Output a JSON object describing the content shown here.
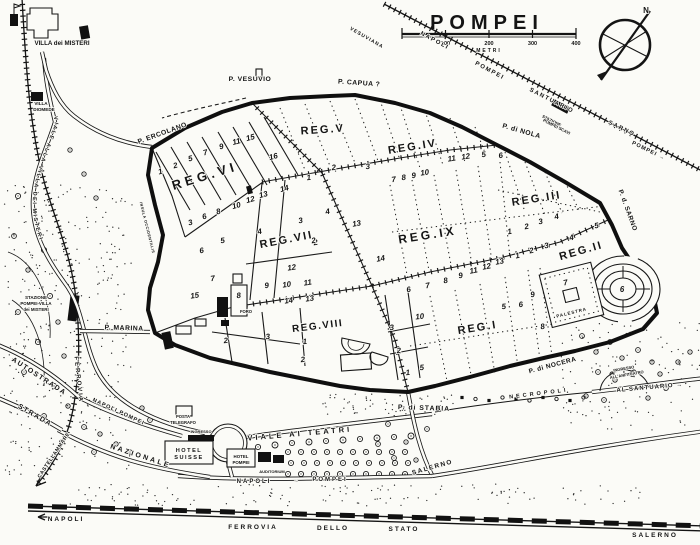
{
  "title": "POMPEI",
  "scale_bar": {
    "unit": "METRI",
    "ticks": [
      "100",
      "200",
      "300",
      "400"
    ]
  },
  "compass": {
    "north": "N"
  },
  "roads_text": {
    "viale_alla_villa": "VIALE ALLA VILLA DEI MISTERI"
  },
  "regions": [
    {
      "name": "region-label-vi",
      "text": "REG.VI",
      "x": 206,
      "y": 180,
      "rot": -17,
      "size": 13,
      "ls": 4
    },
    {
      "name": "region-label-v",
      "text": "REG.V",
      "x": 323,
      "y": 133,
      "rot": -4,
      "size": 11,
      "ls": 2
    },
    {
      "name": "region-label-iv",
      "text": "REG.IV",
      "x": 413,
      "y": 150,
      "rot": -9,
      "size": 11,
      "ls": 2
    },
    {
      "name": "region-label-iii",
      "text": "REG.III",
      "x": 537,
      "y": 202,
      "rot": -9,
      "size": 11,
      "ls": 2
    },
    {
      "name": "region-label-vii",
      "text": "REG.VII",
      "x": 287,
      "y": 243,
      "rot": -11,
      "size": 11,
      "ls": 2
    },
    {
      "name": "region-label-ix",
      "text": "REG.IX",
      "x": 428,
      "y": 239,
      "rot": -9,
      "size": 12,
      "ls": 3
    },
    {
      "name": "region-label-viii",
      "text": "REG.VIII",
      "x": 318,
      "y": 329,
      "rot": -7,
      "size": 10,
      "ls": 1.5
    },
    {
      "name": "region-label-i",
      "text": "REG.I",
      "x": 478,
      "y": 331,
      "rot": -9,
      "size": 11,
      "ls": 2
    },
    {
      "name": "region-label-ii",
      "text": "REG.II",
      "x": 582,
      "y": 254,
      "rot": -16,
      "size": 11,
      "ls": 2
    }
  ],
  "gates": [
    {
      "name": "gate-label-ercolano",
      "text": "P. ERCOLANO",
      "x": 163,
      "y": 135,
      "rot": -20,
      "size": 6.8,
      "ls": 0.5
    },
    {
      "name": "gate-label-vesuvio",
      "text": "P. VESUVIO",
      "x": 250,
      "y": 81,
      "size": 6.8,
      "ls": 0.5
    },
    {
      "name": "gate-label-capua",
      "text": "P. CAPUA ?",
      "x": 359,
      "y": 85,
      "rot": 4,
      "size": 6.8,
      "ls": 0.5
    },
    {
      "name": "gate-label-nola",
      "text": "P. di NOLA",
      "x": 521,
      "y": 133,
      "rot": 16,
      "size": 6.8,
      "ls": 0.5
    },
    {
      "name": "gate-label-sarno",
      "text": "P. d. SARNO",
      "x": 626,
      "y": 211,
      "rot": 70,
      "size": 6.5,
      "ls": 0.5
    },
    {
      "name": "gate-label-nocera",
      "text": "P. di NOCERA",
      "x": 553,
      "y": 367,
      "rot": -15,
      "size": 6.5,
      "ls": 0.5
    },
    {
      "name": "gate-label-stabia",
      "text": "P. di STABIA",
      "x": 424,
      "y": 410,
      "rot": 2,
      "size": 6.8,
      "ls": 1
    },
    {
      "name": "gate-label-marina",
      "text": "P. MARINA",
      "x": 124,
      "y": 330,
      "rot": 2,
      "size": 6.8,
      "ls": 0.5
    }
  ],
  "railway_labels": [
    {
      "name": "railway-label-vesuviana",
      "text": "VESUVIANA",
      "x": 366,
      "y": 39,
      "rot": 30,
      "size": 5,
      "ls": 1
    },
    {
      "name": "railway-label-napoli",
      "text": "NAPOLI",
      "x": 434,
      "y": 42,
      "rot": 28,
      "size": 6,
      "ls": 1.5
    },
    {
      "name": "railway-label-pompei",
      "text": "POMPEI",
      "x": 489,
      "y": 72,
      "rot": 28,
      "size": 6,
      "ls": 1.5
    },
    {
      "name": "railway-label-santuario",
      "text": "SANTUARIO",
      "x": 551,
      "y": 102,
      "rot": 27,
      "size": 6,
      "ls": 1.5
    },
    {
      "name": "railway-label-stazione-scavi-1",
      "text": "STAZIONE",
      "x": 551,
      "y": 122,
      "rot": 27,
      "size": 4.2
    },
    {
      "name": "railway-label-stazione-scavi-2",
      "text": "POMPEI SCAVI",
      "x": 556,
      "y": 128,
      "rot": 27,
      "size": 4.2
    },
    {
      "name": "railway-label-sarno",
      "text": "SARNO",
      "x": 621,
      "y": 130,
      "rot": 26,
      "size": 6,
      "ls": 1.5
    },
    {
      "name": "railway-label-pompei-arrow",
      "text": "POMPEI →",
      "x": 648,
      "y": 152,
      "rot": 26,
      "size": 5.5,
      "ls": 1
    },
    {
      "name": "railway-label-ferrovia-west",
      "text": "FERROVIA",
      "x": 77,
      "y": 380,
      "rot": 84,
      "size": 6,
      "ls": 2
    },
    {
      "name": "railway-label-castellammare",
      "text": "CASTELLAMMARE",
      "x": 55,
      "y": 456,
      "rot": -56,
      "size": 5.2,
      "ls": 0.5
    },
    {
      "name": "station-misteri-label-1",
      "text": "STAZIONE",
      "x": 36,
      "y": 299,
      "size": 4.4
    },
    {
      "name": "station-misteri-label-2",
      "text": "POMPEI-VILLA",
      "x": 36,
      "y": 305,
      "size": 4.4
    },
    {
      "name": "station-misteri-label-3",
      "text": "dei MISTERI",
      "x": 36,
      "y": 311,
      "size": 4.4
    },
    {
      "name": "railway-label-napoli-fs",
      "text": "NAPOLI",
      "x": 66,
      "y": 521,
      "size": 6.5,
      "ls": 2
    },
    {
      "name": "railway-label-fs-1",
      "text": "FERROVIA",
      "x": 253,
      "y": 529,
      "size": 6.5,
      "ls": 2
    },
    {
      "name": "railway-label-fs-2",
      "text": "DELLO",
      "x": 333,
      "y": 530,
      "size": 6.5,
      "ls": 2
    },
    {
      "name": "railway-label-fs-3",
      "text": "STATO",
      "x": 404,
      "y": 531,
      "size": 6.5,
      "ls": 2
    },
    {
      "name": "railway-label-salerno-fs",
      "text": "SALERNO",
      "x": 655,
      "y": 537,
      "size": 6.5,
      "ls": 2
    }
  ],
  "road_labels": [
    {
      "name": "road-label-autostrada",
      "text": "AUTOSTRADA",
      "x": 38,
      "y": 378,
      "rot": 33,
      "size": 7,
      "ls": 1.5
    },
    {
      "name": "road-label-strada",
      "text": "STRADA",
      "x": 34,
      "y": 417,
      "rot": 30,
      "size": 7,
      "ls": 1.5
    },
    {
      "name": "road-label-nazionale",
      "text": "NAZIONALE",
      "x": 140,
      "y": 458,
      "rot": 18,
      "size": 7,
      "ls": 2.5
    },
    {
      "name": "road-label-napoli-pompei-west",
      "text": "NAPOLI POMPEI",
      "x": 118,
      "y": 413,
      "rot": 25,
      "size": 5.5,
      "ls": 1
    },
    {
      "name": "road-label-napoli",
      "text": "NAPOLI",
      "x": 254,
      "y": 483,
      "size": 6,
      "ls": 2
    },
    {
      "name": "road-label-arrow",
      "text": "→",
      "x": 296,
      "y": 482,
      "size": 5
    },
    {
      "name": "road-label-pompei",
      "text": "POMPEI",
      "x": 330,
      "y": 481,
      "size": 6,
      "ls": 2
    },
    {
      "name": "road-label-salerno",
      "text": "SALERNO",
      "x": 433,
      "y": 469,
      "rot": -16,
      "size": 6.5,
      "ls": 1.5
    },
    {
      "name": "road-label-al-santuario",
      "text": "AL SANTUARIO →",
      "x": 650,
      "y": 389,
      "rot": -5,
      "size": 6,
      "ls": 1
    },
    {
      "name": "road-label-viale-teatri",
      "text": "VIALE AI TEATRI",
      "x": 300,
      "y": 436,
      "rot": -5,
      "size": 7.5,
      "ls": 3
    },
    {
      "name": "road-label-necropoli",
      "text": "NECROPOLI",
      "x": 539,
      "y": 395,
      "rot": -7,
      "size": 5.5,
      "ls": 3
    }
  ],
  "place_labels": [
    {
      "name": "villa-misteri-label",
      "text": "VILLA dei MISTERI",
      "x": 62,
      "y": 45,
      "size": 6.2
    },
    {
      "name": "villa-diomede-label-1",
      "text": "VILLA",
      "x": 41,
      "y": 105,
      "size": 4.6
    },
    {
      "name": "villa-diomede-label-2",
      "text": "DIOMEDE",
      "x": 44,
      "y": 111,
      "size": 4.6
    },
    {
      "name": "hotel-suisse-label-1",
      "text": "HOTEL",
      "x": 189,
      "y": 452,
      "size": 5.6,
      "ls": 1.5
    },
    {
      "name": "hotel-suisse-label-2",
      "text": "SUISSE",
      "x": 189,
      "y": 459,
      "size": 5.6,
      "ls": 1.5
    },
    {
      "name": "hotel-pompei-label-1",
      "text": "HOTEL",
      "x": 241,
      "y": 458,
      "size": 4.4
    },
    {
      "name": "hotel-pompei-label-2",
      "text": "POMPEI",
      "x": 241,
      "y": 464,
      "size": 4.4
    },
    {
      "name": "auditorium-label",
      "text": "AUDITORIUM",
      "x": 272,
      "y": 473,
      "size": 4
    },
    {
      "name": "posta-label-1",
      "text": "POSTA",
      "x": 183,
      "y": 418,
      "size": 4.2
    },
    {
      "name": "posta-label-2",
      "text": "TELEGRAFO",
      "x": 183,
      "y": 424,
      "size": 4.2
    },
    {
      "name": "ingresso-label",
      "text": "INGRESSO",
      "x": 201,
      "y": 433,
      "size": 4
    },
    {
      "name": "ingresso-anfiteatro-label-1",
      "text": "INGRESSO",
      "x": 624,
      "y": 370,
      "rot": -10,
      "size": 4
    },
    {
      "name": "ingresso-anfiteatro-label-2",
      "text": "ALL'ANFITEATRO",
      "x": 627,
      "y": 376,
      "rot": -10,
      "size": 4
    },
    {
      "name": "foro-label",
      "text": "FORO",
      "x": 246,
      "y": 313,
      "size": 4.2
    },
    {
      "name": "palestra-label",
      "text": "PALESTRA",
      "x": 572,
      "y": 314,
      "rot": -14,
      "size": 4.4,
      "ls": 1
    },
    {
      "name": "insula-occidentalis-label",
      "text": "INSULA OCCIDENTALIS",
      "x": 146,
      "y": 228,
      "rot": 76,
      "size": 3.8,
      "ls": 0.5
    }
  ],
  "insula_numbers": [
    {
      "t": "1",
      "x": 161,
      "y": 174,
      "r": -15
    },
    {
      "t": "2",
      "x": 176,
      "y": 168,
      "r": -15
    },
    {
      "t": "5",
      "x": 191,
      "y": 161,
      "r": -15
    },
    {
      "t": "7",
      "x": 206,
      "y": 155,
      "r": -15
    },
    {
      "t": "9",
      "x": 222,
      "y": 149,
      "r": -15
    },
    {
      "t": "11",
      "x": 237,
      "y": 144,
      "r": -15
    },
    {
      "t": "15",
      "x": 251,
      "y": 140,
      "r": -15
    },
    {
      "t": "16",
      "x": 274,
      "y": 159,
      "r": -15
    },
    {
      "t": "3",
      "x": 191,
      "y": 225,
      "r": -15
    },
    {
      "t": "6",
      "x": 205,
      "y": 219,
      "r": -15
    },
    {
      "t": "8",
      "x": 219,
      "y": 214,
      "r": -15
    },
    {
      "t": "10",
      "x": 237,
      "y": 208,
      "r": -15
    },
    {
      "t": "12",
      "x": 251,
      "y": 202,
      "r": -15
    },
    {
      "t": "13",
      "x": 264,
      "y": 197,
      "r": -15
    },
    {
      "t": "14",
      "x": 285,
      "y": 191,
      "r": -15
    },
    {
      "t": "1",
      "x": 309,
      "y": 180,
      "r": -6
    },
    {
      "t": "2",
      "x": 334,
      "y": 170,
      "r": -6
    },
    {
      "t": "3",
      "x": 368,
      "y": 169,
      "r": -6
    },
    {
      "t": "7",
      "x": 394,
      "y": 182,
      "r": -8
    },
    {
      "t": "8",
      "x": 404,
      "y": 180,
      "r": -8
    },
    {
      "t": "9",
      "x": 414,
      "y": 178,
      "r": -8
    },
    {
      "t": "10",
      "x": 425,
      "y": 175,
      "r": -8
    },
    {
      "t": "11",
      "x": 452,
      "y": 161,
      "r": -8
    },
    {
      "t": "12",
      "x": 466,
      "y": 159,
      "r": -8
    },
    {
      "t": "5",
      "x": 484,
      "y": 157,
      "r": -8
    },
    {
      "t": "6",
      "x": 501,
      "y": 158,
      "r": -8
    },
    {
      "t": "1",
      "x": 510,
      "y": 234,
      "r": -10
    },
    {
      "t": "2",
      "x": 527,
      "y": 229,
      "r": -10
    },
    {
      "t": "3",
      "x": 541,
      "y": 224,
      "r": -10
    },
    {
      "t": "4",
      "x": 557,
      "y": 219,
      "r": -10
    },
    {
      "t": "3",
      "x": 301,
      "y": 223,
      "r": -10
    },
    {
      "t": "4",
      "x": 328,
      "y": 214,
      "r": -10
    },
    {
      "t": "13",
      "x": 357,
      "y": 226,
      "r": -10
    },
    {
      "t": "2",
      "x": 316,
      "y": 245,
      "r": -10
    },
    {
      "t": "14",
      "x": 381,
      "y": 261,
      "r": -10
    },
    {
      "t": "6",
      "x": 409,
      "y": 292,
      "r": -10
    },
    {
      "t": "7",
      "x": 428,
      "y": 288,
      "r": -10
    },
    {
      "t": "8",
      "x": 446,
      "y": 283,
      "r": -10
    },
    {
      "t": "9",
      "x": 461,
      "y": 278,
      "r": -10
    },
    {
      "t": "11",
      "x": 474,
      "y": 273,
      "r": -10
    },
    {
      "t": "12",
      "x": 487,
      "y": 269,
      "r": -10
    },
    {
      "t": "13",
      "x": 500,
      "y": 264,
      "r": -10
    },
    {
      "t": "3",
      "x": 392,
      "y": 330,
      "r": -6
    },
    {
      "t": "10",
      "x": 420,
      "y": 319,
      "r": -6
    },
    {
      "t": "5",
      "x": 504,
      "y": 309,
      "r": -6
    },
    {
      "t": "6",
      "x": 521,
      "y": 307,
      "r": -6
    },
    {
      "t": "2",
      "x": 399,
      "y": 353,
      "r": -5
    },
    {
      "t": "1",
      "x": 408,
      "y": 375,
      "r": -5
    },
    {
      "t": "5",
      "x": 422,
      "y": 370,
      "r": -5
    },
    {
      "t": "1",
      "x": 518,
      "y": 258,
      "r": -12
    },
    {
      "t": "2",
      "x": 532,
      "y": 253,
      "r": -12
    },
    {
      "t": "3",
      "x": 547,
      "y": 248,
      "r": -12
    },
    {
      "t": "4",
      "x": 572,
      "y": 240,
      "r": -12
    },
    {
      "t": "5",
      "x": 597,
      "y": 228,
      "r": -12
    },
    {
      "t": "9",
      "x": 533,
      "y": 297,
      "r": -10
    },
    {
      "t": "8",
      "x": 543,
      "y": 329,
      "r": -10
    },
    {
      "t": "7",
      "x": 566,
      "y": 285,
      "r": -12
    },
    {
      "t": "6",
      "x": 622,
      "y": 292,
      "r": 0
    },
    {
      "t": "2",
      "x": 226,
      "y": 343,
      "r": -5
    },
    {
      "t": "3",
      "x": 268,
      "y": 339,
      "r": -5
    },
    {
      "t": "1",
      "x": 305,
      "y": 344,
      "r": -5
    },
    {
      "t": "2",
      "x": 303,
      "y": 362,
      "r": -5
    },
    {
      "t": "4",
      "x": 260,
      "y": 234,
      "r": -10
    },
    {
      "t": "5",
      "x": 223,
      "y": 243,
      "r": -10
    },
    {
      "t": "6",
      "x": 202,
      "y": 253,
      "r": -10
    },
    {
      "t": "15",
      "x": 195,
      "y": 298,
      "r": -8
    },
    {
      "t": "7",
      "x": 213,
      "y": 281,
      "r": -8
    },
    {
      "t": "8",
      "x": 239,
      "y": 298,
      "r": -8
    },
    {
      "t": "9",
      "x": 267,
      "y": 288,
      "r": -8
    },
    {
      "t": "10",
      "x": 287,
      "y": 287,
      "r": -8
    },
    {
      "t": "11",
      "x": 308,
      "y": 285,
      "r": -8
    },
    {
      "t": "12",
      "x": 292,
      "y": 270,
      "r": -8
    },
    {
      "t": "14",
      "x": 289,
      "y": 303,
      "r": -8
    },
    {
      "t": "13",
      "x": 310,
      "y": 301,
      "r": -8
    },
    {
      "t": "2",
      "x": 314,
      "y": 243,
      "r": -10
    }
  ]
}
